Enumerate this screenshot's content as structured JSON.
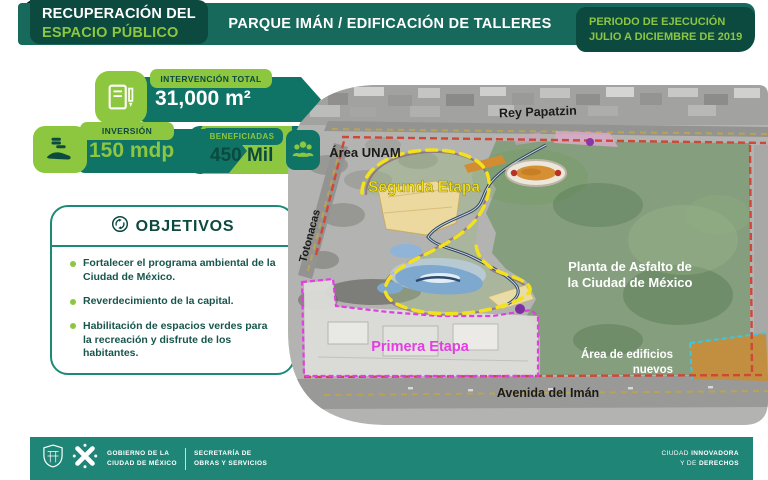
{
  "header": {
    "program_line1": "RECUPERACIÓN DEL",
    "program_line2": "ESPACIO PÚBLICO",
    "title": "PARQUE IMÁN / EDIFICACIÓN DE TALLERES",
    "period_label": "PERIODO DE EJECUCIÓN",
    "period_value": "JULIO A DICIEMBRE DE 2019"
  },
  "stats": [
    {
      "label": "INTERVENCIÓN TOTAL",
      "value": "31,000 m²",
      "icon": "notebook-pencil-icon"
    },
    {
      "label": "INVERSIÓN",
      "value": "150 mdp",
      "icon": "money-hand-icon"
    },
    {
      "label": "BENEFICIADAS",
      "value": "450 Mil",
      "icon": "people-icon"
    }
  ],
  "objectives": {
    "title": "OBJETIVOS",
    "icon": "circular-arrows-icon",
    "items": [
      "Fortalecer el programa ambiental de la Ciudad de México.",
      "Reverdecimiento de la capital.",
      "Habilitación de espacios verdes para la recreación y disfrute de los habitantes."
    ]
  },
  "map": {
    "labels": {
      "street_top": "Rey Papatzin",
      "street_left": "Totonacas",
      "street_bottom": "Avenida del Imán",
      "area_unam": "Área UNAM",
      "stage2": "Segunda Etapa",
      "stage1": "Primera Etapa",
      "asfalto_line1": "Planta de Asfalto de",
      "asfalto_line2": "la Ciudad de México",
      "edificios_line1": "Área de edificios",
      "edificios_line2": "nuevos"
    }
  },
  "footer": {
    "gov_line1": "GOBIERNO DE LA",
    "gov_line2": "CIUDAD DE MÉXICO",
    "dept_line1": "SECRETARÍA DE",
    "dept_line2": "OBRAS Y SERVICIOS",
    "right1_normal": "CIUDAD ",
    "right1_bold": "INNOVADORA",
    "right2_normal": "Y DE ",
    "right2_bold": "DERECHOS"
  },
  "colors": {
    "header_teal": "#17695c",
    "dark_teal_box": "#0c4a40",
    "badge_teal": "#0f7465",
    "bright_green": "#8dc63f",
    "footer_teal": "#1f8577",
    "stage2_yellow": "#f2e11c",
    "stage1_magenta": "#e23ee2",
    "boundary_red": "#ce4838"
  }
}
